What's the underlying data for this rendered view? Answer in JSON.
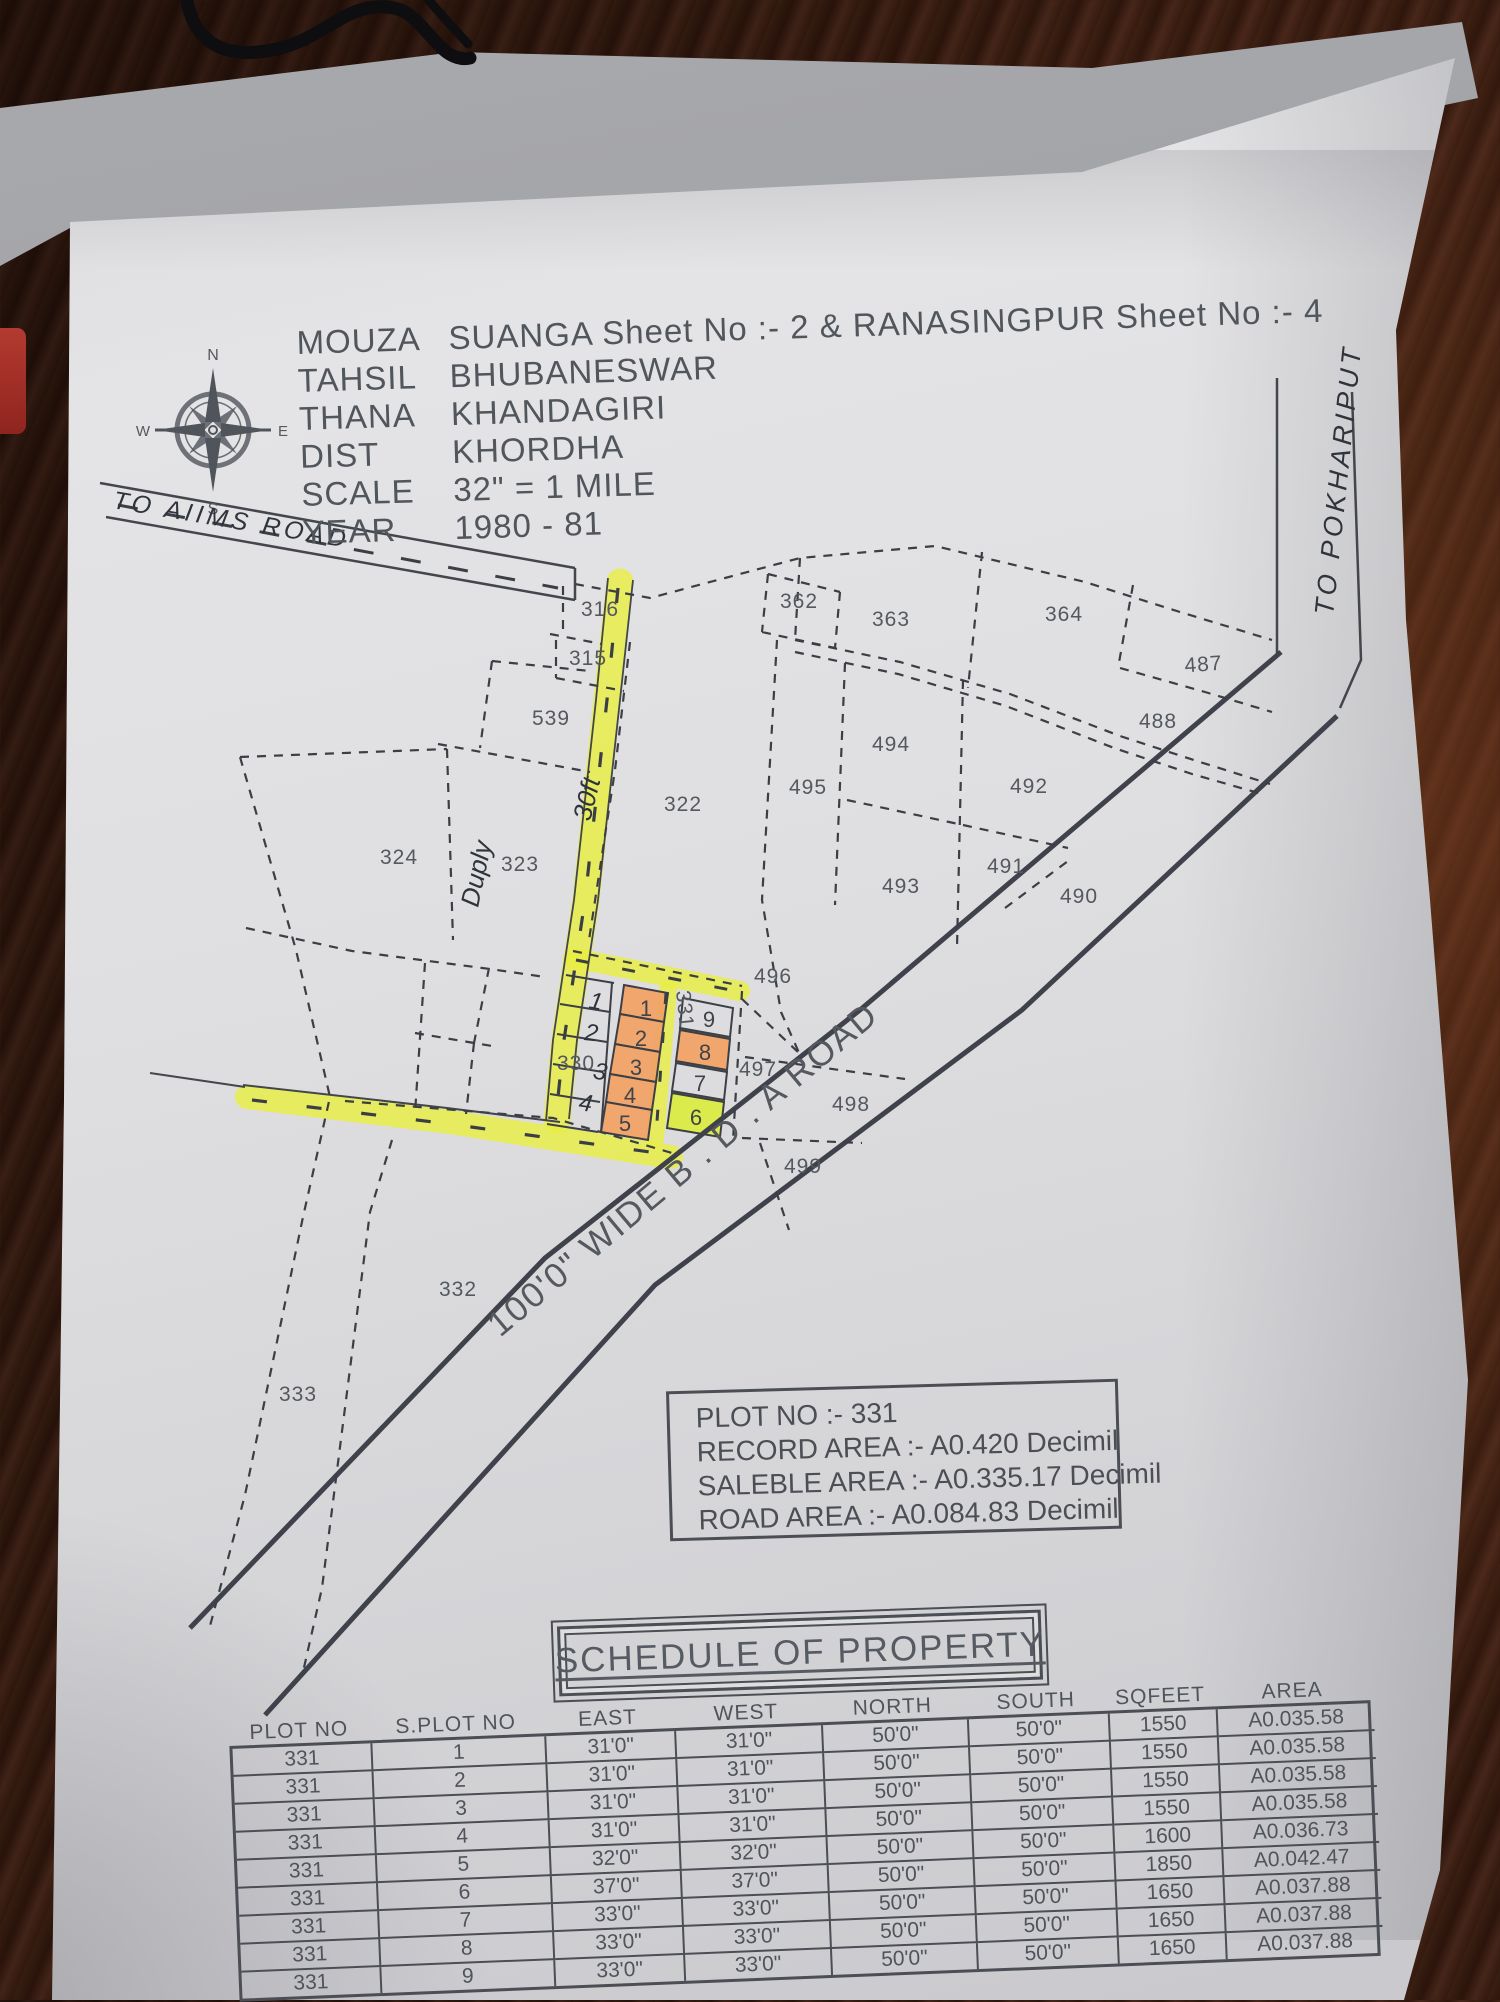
{
  "header": {
    "lines": [
      {
        "label": "MOUZA",
        "value": "SUANGA  Sheet  No :- 2 & RANASINGPUR Sheet No :- 4"
      },
      {
        "label": "TAHSIL",
        "value": "BHUBANESWAR"
      },
      {
        "label": "THANA",
        "value": "KHANDAGIRI"
      },
      {
        "label": "DIST",
        "value": "KHORDHA"
      },
      {
        "label": "SCALE",
        "value": "32\" = 1 MILE"
      },
      {
        "label": "YEAR",
        "value": "1980 - 81"
      }
    ]
  },
  "compass": {
    "north": "N",
    "south": "S",
    "east": "E",
    "west": "W"
  },
  "handwritten": {
    "to_aiims": "TO AIIMS ROAD",
    "to_pokhariput": "TO POKHARIPUT",
    "thirty_feet": "30ft",
    "duply": "Duply",
    "marks": [
      "1",
      "2",
      "3",
      "4"
    ]
  },
  "map": {
    "road_label": "100'0\" WIDE B . D . A ROAD",
    "plot_labels": [
      "316",
      "315",
      "539",
      "322",
      "324",
      "323",
      "495",
      "362",
      "363",
      "364",
      "487",
      "488",
      "494",
      "492",
      "491",
      "493",
      "490",
      "496",
      "497",
      "498",
      "499",
      "330",
      "332",
      "333",
      "331"
    ],
    "subplot_numbers": [
      "1",
      "2",
      "3",
      "4",
      "5",
      "6",
      "7",
      "8",
      "9"
    ]
  },
  "info_box": {
    "lines": [
      "PLOT NO :- 331",
      "RECORD AREA :- A0.420 Decimil",
      "SALEBLE AREA :- A0.335.17  Decimil",
      "ROAD AREA  :- A0.084.83 Decimil"
    ]
  },
  "schedule": {
    "title": "SCHEDULE OF PROPERTY",
    "columns": [
      "PLOT NO",
      "S.PLOT NO",
      "EAST",
      "WEST",
      "NORTH",
      "SOUTH",
      "SQFEET",
      "AREA"
    ],
    "rows": [
      [
        "331",
        "1",
        "31'0\"",
        "31'0\"",
        "50'0\"",
        "50'0\"",
        "1550",
        "A0.035.58"
      ],
      [
        "331",
        "2",
        "31'0\"",
        "31'0\"",
        "50'0\"",
        "50'0\"",
        "1550",
        "A0.035.58"
      ],
      [
        "331",
        "3",
        "31'0\"",
        "31'0\"",
        "50'0\"",
        "50'0\"",
        "1550",
        "A0.035.58"
      ],
      [
        "331",
        "4",
        "31'0\"",
        "31'0\"",
        "50'0\"",
        "50'0\"",
        "1550",
        "A0.035.58"
      ],
      [
        "331",
        "5",
        "32'0\"",
        "32'0\"",
        "50'0\"",
        "50'0\"",
        "1600",
        "A0.036.73"
      ],
      [
        "331",
        "6",
        "37'0\"",
        "37'0\"",
        "50'0\"",
        "50'0\"",
        "1850",
        "A0.042.47"
      ],
      [
        "331",
        "7",
        "33'0\"",
        "33'0\"",
        "50'0\"",
        "50'0\"",
        "1650",
        "A0.037.88"
      ],
      [
        "331",
        "8",
        "33'0\"",
        "33'0\"",
        "50'0\"",
        "50'0\"",
        "1650",
        "A0.037.88"
      ],
      [
        "331",
        "9",
        "33'0\"",
        "33'0\"",
        "50'0\"",
        "50'0\"",
        "1650",
        "A0.037.88"
      ]
    ]
  },
  "colors": {
    "highlight_yellow": "#e8ef3e",
    "highlight_orange": "#f0a265",
    "highlight_green": "#dcec3c",
    "ink": "#3b3e44",
    "paper": "#dededf"
  }
}
